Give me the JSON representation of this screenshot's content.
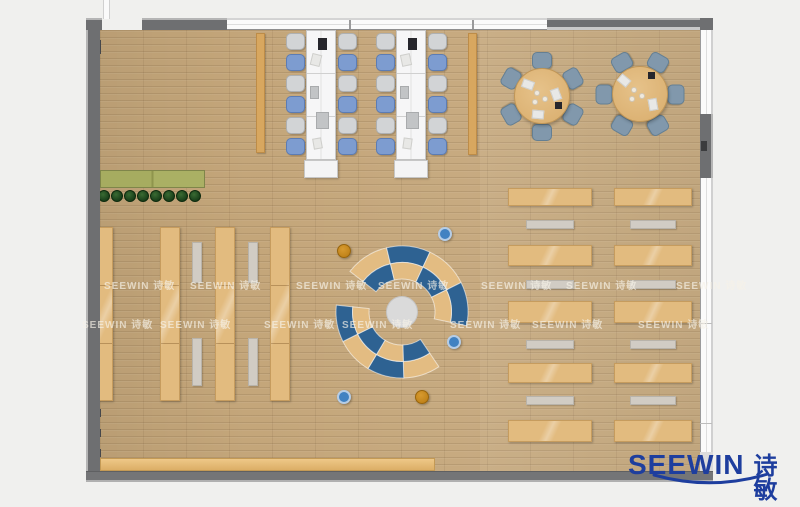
{
  "watermark": {
    "text": "SEEWIN 诗敏",
    "rows": [
      {
        "y": 277,
        "xs": [
          104,
          190,
          296,
          378,
          481,
          566,
          676
        ]
      },
      {
        "y": 316,
        "xs": [
          82,
          160,
          264,
          342,
          450,
          532,
          638
        ]
      }
    ]
  },
  "logo": {
    "en": "SEEWIN",
    "zh": "诗敏",
    "color": "#1e3e9e"
  },
  "colors": {
    "floor": "#c4a67a",
    "wall": "#6e6f71",
    "shelf_tan": "#e2bb7f",
    "arc_blue": "#2e6292",
    "arc_tan": "#e3bc82",
    "chair_blue": "#7d9cd0",
    "chair_gray": "#d2d4d6",
    "table_chair": "#8198ac",
    "logo_blue": "#1e3e9e"
  },
  "floorplan": {
    "rects": [
      {
        "name": "planter-box",
        "cls": "planter",
        "x": 100,
        "y": 170,
        "w": 105,
        "h": 18
      },
      {
        "name": "storage-strip",
        "cls": "cab",
        "x": 256,
        "y": 33,
        "w": 9,
        "h": 120
      },
      {
        "name": "storage-strip",
        "cls": "cab",
        "x": 468,
        "y": 33,
        "w": 9,
        "h": 122
      },
      {
        "name": "bookshelf",
        "cls": "shelf v",
        "x": 98,
        "y": 227,
        "w": 15,
        "h": 174
      },
      {
        "name": "bookshelf",
        "cls": "shelf v",
        "x": 160,
        "y": 227,
        "w": 20,
        "h": 174
      },
      {
        "name": "bookshelf",
        "cls": "shelf v",
        "x": 215,
        "y": 227,
        "w": 20,
        "h": 174
      },
      {
        "name": "bookshelf",
        "cls": "shelf v",
        "x": 270,
        "y": 227,
        "w": 20,
        "h": 174
      },
      {
        "name": "aisle-bench",
        "cls": "bench",
        "x": 192,
        "y": 242,
        "w": 10,
        "h": 41
      },
      {
        "name": "aisle-bench",
        "cls": "bench",
        "x": 192,
        "y": 338,
        "w": 10,
        "h": 48
      },
      {
        "name": "aisle-bench",
        "cls": "bench",
        "x": 248,
        "y": 242,
        "w": 10,
        "h": 41
      },
      {
        "name": "aisle-bench",
        "cls": "bench",
        "x": 248,
        "y": 338,
        "w": 10,
        "h": 48
      },
      {
        "name": "reading-table",
        "cls": "shelf h",
        "x": 508,
        "y": 188,
        "w": 84,
        "h": 18
      },
      {
        "name": "reading-table",
        "cls": "shelf h",
        "x": 508,
        "y": 245,
        "w": 84,
        "h": 21
      },
      {
        "name": "reading-table",
        "cls": "shelf h",
        "x": 508,
        "y": 301,
        "w": 84,
        "h": 22
      },
      {
        "name": "reading-table",
        "cls": "shelf h",
        "x": 508,
        "y": 363,
        "w": 84,
        "h": 20
      },
      {
        "name": "reading-table",
        "cls": "shelf h",
        "x": 508,
        "y": 420,
        "w": 84,
        "h": 22
      },
      {
        "name": "reading-table",
        "cls": "shelf h",
        "x": 614,
        "y": 188,
        "w": 78,
        "h": 18
      },
      {
        "name": "reading-table",
        "cls": "shelf h",
        "x": 614,
        "y": 245,
        "w": 78,
        "h": 21
      },
      {
        "name": "reading-table",
        "cls": "shelf h",
        "x": 614,
        "y": 301,
        "w": 78,
        "h": 22
      },
      {
        "name": "reading-table",
        "cls": "shelf h",
        "x": 614,
        "y": 363,
        "w": 78,
        "h": 20
      },
      {
        "name": "reading-table",
        "cls": "shelf h",
        "x": 614,
        "y": 420,
        "w": 78,
        "h": 22
      },
      {
        "name": "reading-bench",
        "cls": "bench h",
        "x": 526,
        "y": 220,
        "w": 48,
        "h": 9
      },
      {
        "name": "reading-bench",
        "cls": "bench h",
        "x": 526,
        "y": 280,
        "w": 48,
        "h": 9
      },
      {
        "name": "reading-bench",
        "cls": "bench h",
        "x": 526,
        "y": 340,
        "w": 48,
        "h": 9
      },
      {
        "name": "reading-bench",
        "cls": "bench h",
        "x": 526,
        "y": 396,
        "w": 48,
        "h": 9
      },
      {
        "name": "reading-bench",
        "cls": "bench h",
        "x": 630,
        "y": 220,
        "w": 46,
        "h": 9
      },
      {
        "name": "reading-bench",
        "cls": "bench h",
        "x": 630,
        "y": 280,
        "w": 46,
        "h": 9
      },
      {
        "name": "reading-bench",
        "cls": "bench h",
        "x": 630,
        "y": 340,
        "w": 46,
        "h": 9
      },
      {
        "name": "reading-bench",
        "cls": "bench h",
        "x": 630,
        "y": 396,
        "w": 46,
        "h": 9
      },
      {
        "name": "bottom-cabinet",
        "cls": "lowboard",
        "x": 100,
        "y": 458,
        "w": 335,
        "h": 13
      },
      {
        "name": "wall-column",
        "cls": "wallcol",
        "x": 94,
        "y": 40,
        "w": 7,
        "h": 14
      },
      {
        "name": "wall-column",
        "cls": "wallcol",
        "x": 95,
        "y": 409,
        "w": 6,
        "h": 8
      },
      {
        "name": "wall-column",
        "cls": "wallcol",
        "x": 95,
        "y": 429,
        "w": 6,
        "h": 8
      },
      {
        "name": "wall-column",
        "cls": "wallcol",
        "x": 95,
        "y": 449,
        "w": 6,
        "h": 8
      }
    ],
    "circles": [
      {
        "name": "plant",
        "cls": "plant",
        "cx": 104,
        "cy": 196,
        "r": 6
      },
      {
        "name": "plant",
        "cls": "plant",
        "cx": 117,
        "cy": 196,
        "r": 6
      },
      {
        "name": "plant",
        "cls": "plant",
        "cx": 130,
        "cy": 196,
        "r": 6
      },
      {
        "name": "plant",
        "cls": "plant",
        "cx": 143,
        "cy": 196,
        "r": 6
      },
      {
        "name": "plant",
        "cls": "plant",
        "cx": 156,
        "cy": 196,
        "r": 6
      },
      {
        "name": "plant",
        "cls": "plant",
        "cx": 169,
        "cy": 196,
        "r": 6
      },
      {
        "name": "plant",
        "cls": "plant",
        "cx": 182,
        "cy": 196,
        "r": 6
      },
      {
        "name": "plant",
        "cls": "plant",
        "cx": 195,
        "cy": 196,
        "r": 6
      },
      {
        "name": "stool-blue",
        "cls": "stool-blue",
        "cx": 445,
        "cy": 234,
        "r": 7
      },
      {
        "name": "stool-blue",
        "cls": "stool-blue",
        "cx": 454,
        "cy": 342,
        "r": 7
      },
      {
        "name": "stool-blue",
        "cls": "stool-blue",
        "cx": 344,
        "cy": 397,
        "r": 7
      },
      {
        "name": "stool-ochre",
        "cls": "stool-ochre",
        "cx": 344,
        "cy": 251,
        "r": 7
      },
      {
        "name": "stool-ochre",
        "cls": "stool-ochre",
        "cx": 422,
        "cy": 397,
        "r": 7
      }
    ],
    "desks": [
      {
        "x": 306,
        "y": 30,
        "w": 30,
        "h": 130,
        "endcap": {
          "x": 304,
          "y": 160,
          "w": 34,
          "h": 18
        },
        "chair_left_x": 286,
        "chair_right_x": 338,
        "chair_ys": [
          33,
          54,
          75,
          96,
          117,
          138
        ],
        "pattern": [
          "gray",
          "blue",
          "gray",
          "blue",
          "gray",
          "blue"
        ],
        "items": [
          {
            "dx": 12,
            "dy": 8,
            "w": 9,
            "h": 12,
            "cls": "item-dark"
          },
          {
            "dx": 5,
            "dy": 24,
            "w": 10,
            "h": 12,
            "cls": "item-paper",
            "rot": 14
          },
          {
            "dx": 4,
            "dy": 56,
            "w": 9,
            "h": 13,
            "cls": "item-gray"
          },
          {
            "dx": 10,
            "dy": 82,
            "w": 13,
            "h": 17,
            "cls": "item-gray"
          },
          {
            "dx": 7,
            "dy": 108,
            "w": 9,
            "h": 11,
            "cls": "item-paper",
            "rot": -10
          }
        ]
      },
      {
        "x": 396,
        "y": 30,
        "w": 30,
        "h": 130,
        "endcap": {
          "x": 394,
          "y": 160,
          "w": 34,
          "h": 18
        },
        "chair_left_x": 376,
        "chair_right_x": 428,
        "chair_ys": [
          33,
          54,
          75,
          96,
          117,
          138
        ],
        "pattern": [
          "gray",
          "blue",
          "gray",
          "blue",
          "gray",
          "blue"
        ],
        "items": [
          {
            "dx": 12,
            "dy": 8,
            "w": 9,
            "h": 12,
            "cls": "item-dark"
          },
          {
            "dx": 5,
            "dy": 24,
            "w": 10,
            "h": 12,
            "cls": "item-paper",
            "rot": -12
          },
          {
            "dx": 4,
            "dy": 56,
            "w": 9,
            "h": 13,
            "cls": "item-gray"
          },
          {
            "dx": 10,
            "dy": 82,
            "w": 13,
            "h": 17,
            "cls": "item-gray"
          },
          {
            "dx": 7,
            "dy": 108,
            "w": 9,
            "h": 11,
            "cls": "item-paper",
            "rot": 8
          }
        ]
      }
    ],
    "round_tables": [
      {
        "cx": 542,
        "cy": 96,
        "r": 28,
        "chair_dist": 36,
        "chair_angles": [
          -90,
          -30,
          30,
          90,
          150,
          210
        ],
        "papers": [
          {
            "dx": -14,
            "dy": -12,
            "rot": 20
          },
          {
            "dx": 14,
            "dy": -2,
            "rot": 70
          },
          {
            "dx": -4,
            "dy": 18,
            "rot": 5
          }
        ],
        "cups": [
          {
            "dx": -5,
            "dy": -3
          },
          {
            "dx": 3,
            "dy": 3
          },
          {
            "dx": -7,
            "dy": 6
          }
        ],
        "dark": {
          "dx": 13,
          "dy": 6
        }
      },
      {
        "cx": 640,
        "cy": 94,
        "r": 28,
        "chair_dist": 36,
        "chair_angles": [
          -120,
          -60,
          0,
          60,
          120,
          180
        ],
        "papers": [
          {
            "dx": -16,
            "dy": -14,
            "rot": 40
          },
          {
            "dx": 13,
            "dy": 10,
            "rot": 80
          }
        ],
        "cups": [
          {
            "dx": -6,
            "dy": -4
          },
          {
            "dx": 2,
            "dy": 2
          },
          {
            "dx": -8,
            "dy": 5
          }
        ],
        "dark": {
          "dx": 8,
          "dy": -22
        }
      }
    ],
    "lounge": {
      "cx": 402,
      "cy": 312,
      "hub_r": 15.5,
      "r_inner": 33,
      "r_mid": 49.5,
      "r_outer": 66,
      "groups": [
        {
          "a0": -142,
          "a1": 12,
          "segs": 4,
          "outer": [
            "tan",
            "blue",
            "tan",
            "blue"
          ],
          "inner": [
            "blue",
            "tan",
            "blue",
            "tan"
          ]
        },
        {
          "a0": 56,
          "a1": 186,
          "segs": 4,
          "outer": [
            "tan",
            "blue",
            "tan",
            "blue"
          ],
          "inner": [
            "blue",
            "tan",
            "blue",
            "tan"
          ]
        }
      ],
      "blue": "#2e6292",
      "tan": "#e3bc82",
      "hub_color": "#dadada"
    }
  }
}
